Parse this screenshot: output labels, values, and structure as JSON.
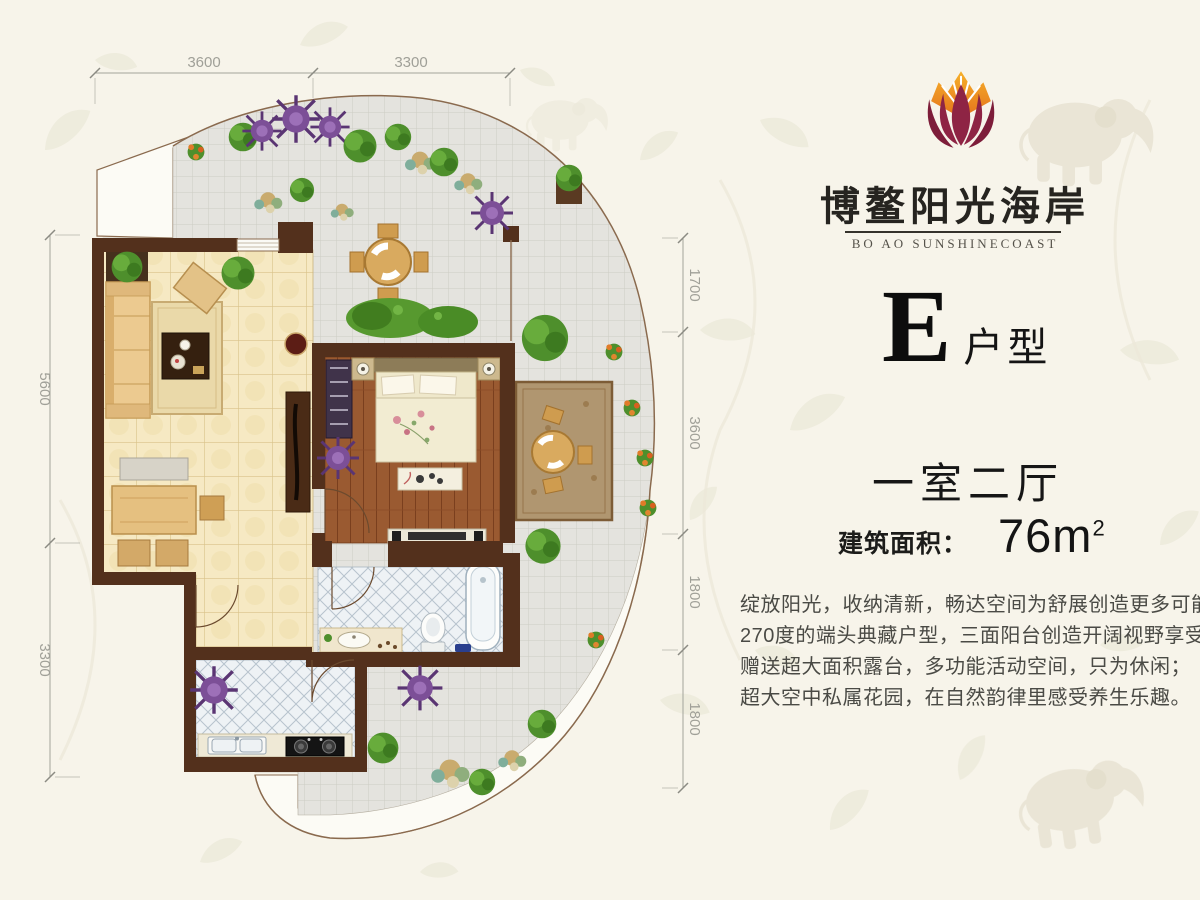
{
  "page": {
    "background": "#f7f4ea"
  },
  "brand": {
    "logo_icon": "lotus-flame-logo",
    "name_cn": "博鳌阳光海岸",
    "name_en": "BO AO SUNSHINECOAST",
    "logo_colors": {
      "petal": "#8e2444",
      "flame_outer": "#e4731c",
      "flame_inner": "#f6b02a"
    }
  },
  "unit": {
    "letter": "E",
    "type_label": "户型"
  },
  "summary": {
    "layout": "一室二厅",
    "area_label": "建筑面积：",
    "area_value": "76m",
    "area_superscript": "2"
  },
  "description": {
    "lines": [
      "绽放阳光，收纳清新，畅达空间为舒展创造更多可能；",
      "270度的端头典藏户型，三面阳台创造开阔视野享受；",
      "赠送超大面积露台，多功能活动空间，只为休闲；",
      "超大空中私属花园，在自然韵律里感受养生乐趣。"
    ]
  },
  "plan": {
    "dims_top": [
      "3600",
      "3300"
    ],
    "dims_left": [
      "5600",
      "3300"
    ],
    "dims_right": [
      "1700",
      "3600",
      "1800",
      "1800"
    ]
  },
  "colors": {
    "wall": "#53301c",
    "wood_floor": "#9a5a31",
    "beige_floor": "#f6e9c3",
    "terrace_tile": "#e4e3de",
    "bath_tile": "#eef2f5",
    "accent_purple": "#7c4f97",
    "accent_green": "#4e8f2c"
  }
}
